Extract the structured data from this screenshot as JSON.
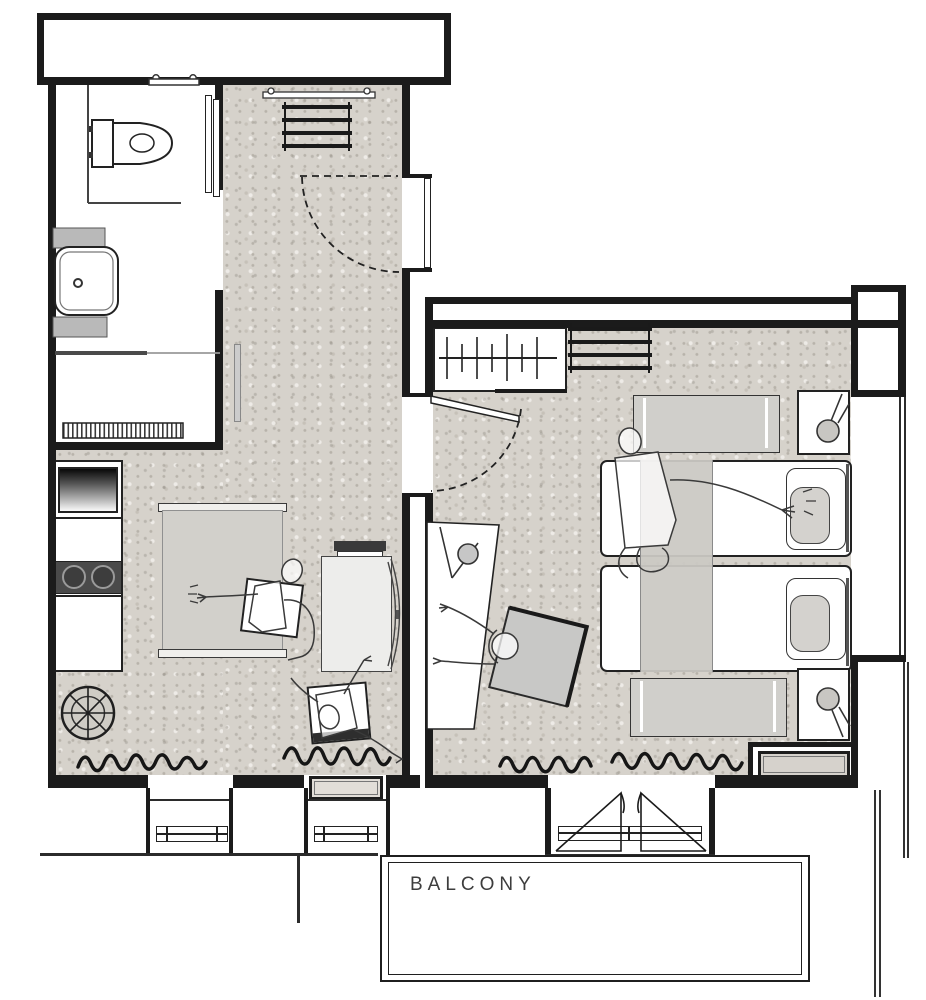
{
  "document": {
    "type": "apartment-floor-plan"
  },
  "labels": {
    "balcony": "BALCONY"
  },
  "colors": {
    "background": "#ffffff",
    "walls": "#1b1b1b",
    "floor_texture": "#d6d2cb",
    "furniture_light_gray": "#d2d0cb",
    "cooktop_dark": "#4a4a4a",
    "sketch_line": "#3a3a3a"
  },
  "rooms": [
    "bathroom",
    "entry-hall",
    "kitchen-living-room",
    "bedroom",
    "balcony"
  ],
  "elements": [
    "toilet",
    "wall-shelf",
    "bathroom-sink",
    "shower-mat",
    "sliding-door",
    "kitchen-sink",
    "cooktop",
    "kitchen-counter",
    "round-table",
    "sofa",
    "dining-table",
    "chairs",
    "people-sketches",
    "wardrobe",
    "coat-rack",
    "entry-door",
    "bedroom-door",
    "desk",
    "desk-lamp",
    "desk-chair",
    "monitor",
    "single-bed",
    "pillow",
    "bolster-cushion",
    "bed-runner",
    "bench",
    "nightstand",
    "table-lamp",
    "radiator",
    "window",
    "balcony-door",
    "curtain-squiggles"
  ]
}
